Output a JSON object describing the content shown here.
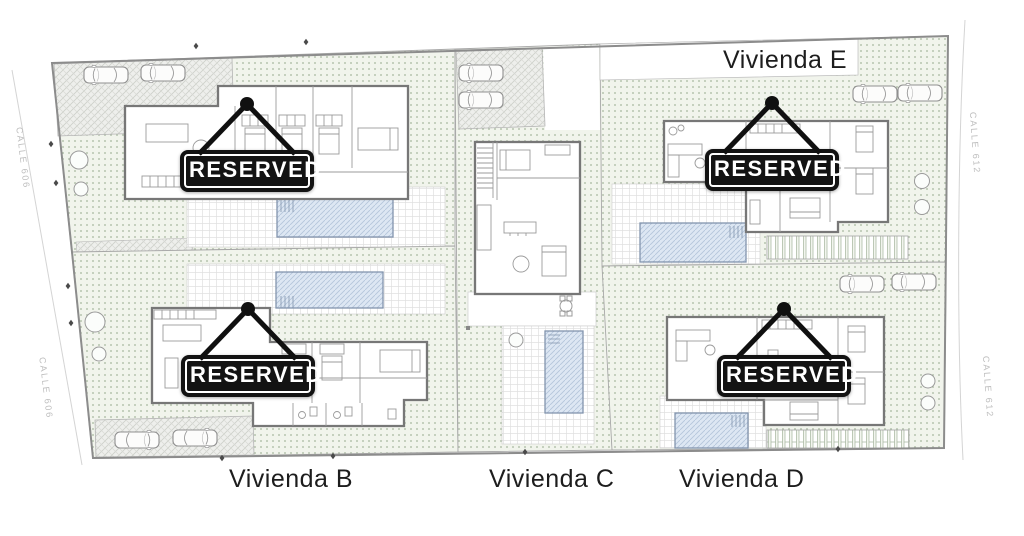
{
  "plan": {
    "units": {
      "top_right_label": "Vivienda E",
      "bottom_left_label": "Vivienda B",
      "bottom_center_label": "Vivienda C",
      "bottom_right_label": "Vivienda D"
    },
    "streets": {
      "left_upper": "CALLE 606",
      "left_lower": "CALLE 606",
      "right_upper": "CALLE 612",
      "right_lower": "CALLE 612"
    },
    "signs": [
      {
        "plot": "top-left",
        "label": "RESERVED"
      },
      {
        "plot": "bottom-left",
        "label": "RESERVED"
      },
      {
        "plot": "top-right",
        "label": "RESERVED"
      },
      {
        "plot": "bottom-right",
        "label": "RESERVED"
      }
    ],
    "colors": {
      "sign_background": "#131313",
      "sign_text": "#ffffff",
      "garden_dot": "#a6b79e",
      "pool_fill": "#dde7f3",
      "wall_gray": "#777777",
      "street_text": "#bdbdbd"
    }
  }
}
